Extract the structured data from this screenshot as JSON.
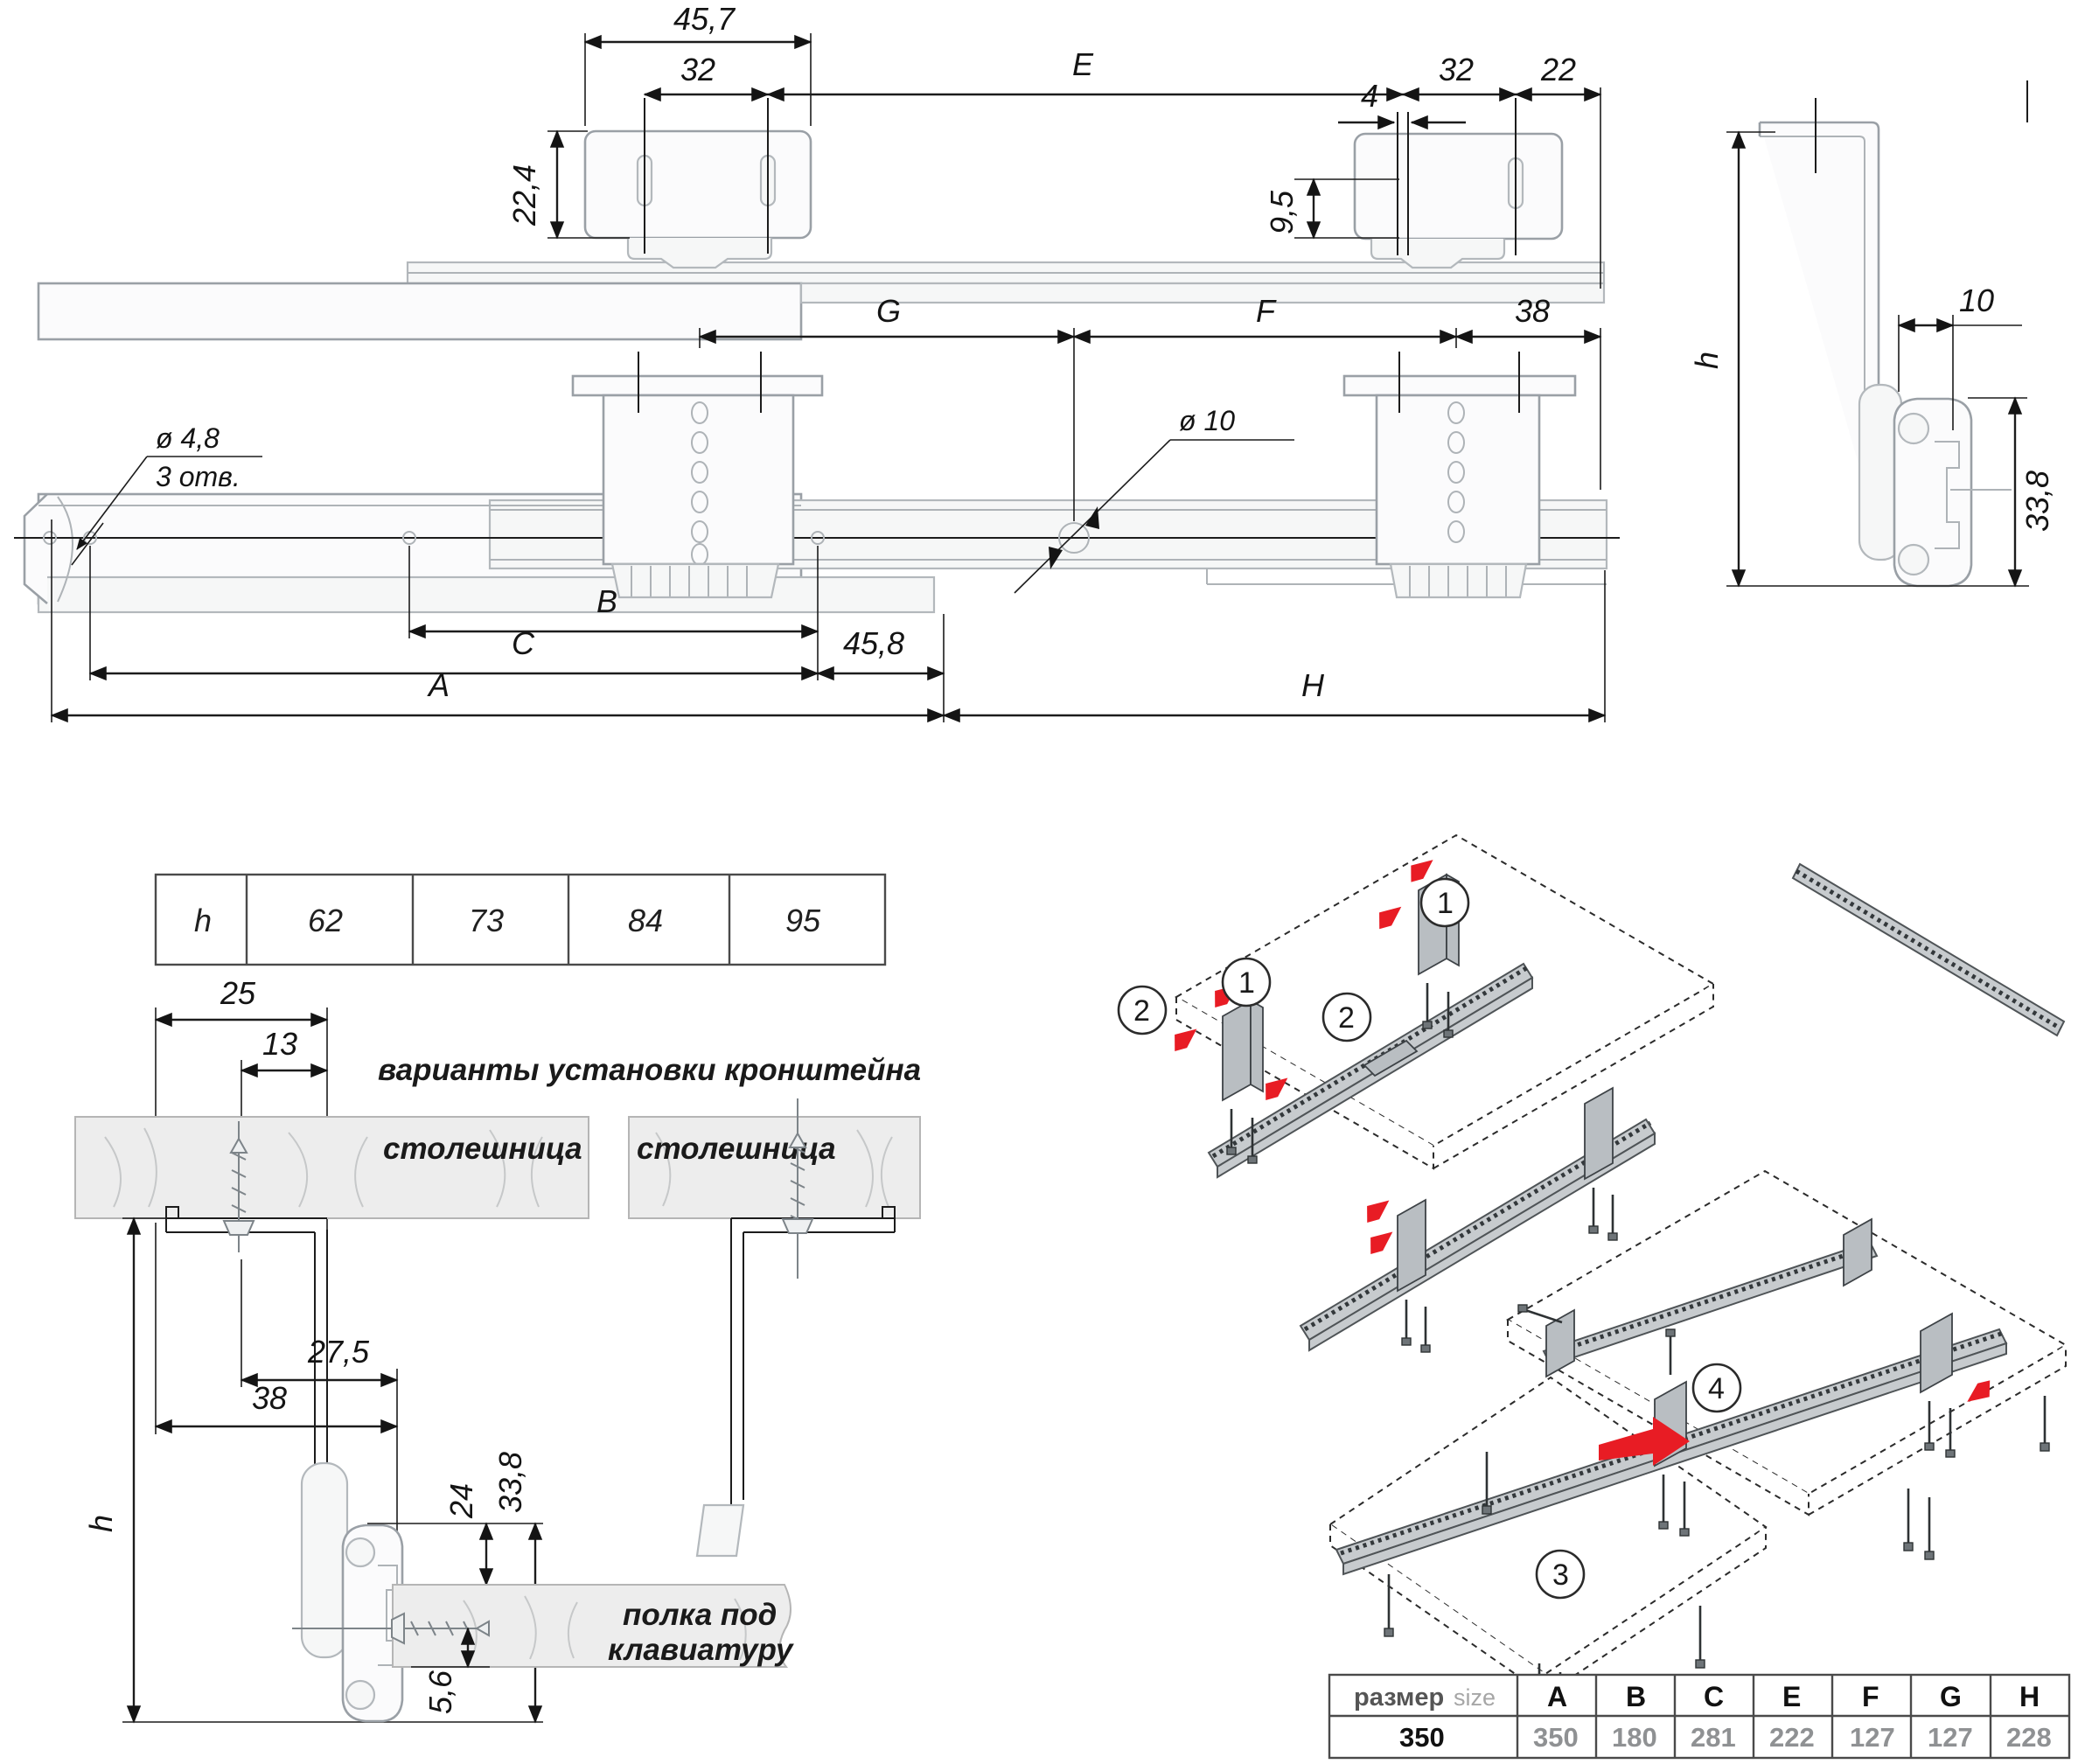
{
  "colors": {
    "accent_red": "#e81c24",
    "line_dark": "#1c1c1c",
    "part_gray": "#9aa0a6",
    "fill_light": "#f1f2f3",
    "slab_gray": "#ececec",
    "muted_value": "#8f9193"
  },
  "top_view": {
    "d45_7": "45,7",
    "d32_left": "32",
    "dE": "E",
    "d32_right": "32",
    "d22": "22",
    "d22_4": "22,4",
    "d9_5": "9,5",
    "d4": "4"
  },
  "plan_view": {
    "dG": "G",
    "dF": "F",
    "d38": "38",
    "dia4_8": "ø 4,8",
    "dia4_8_qty": "3 отв.",
    "dia10": "ø 10",
    "dB": "B",
    "dC": "C",
    "d45_8": "45,8",
    "dA": "A",
    "dH": "H"
  },
  "side_view": {
    "dh": "h",
    "d10": "10",
    "d33_8": "33,8"
  },
  "h_table": {
    "label": "h",
    "values": [
      "62",
      "73",
      "84",
      "95"
    ]
  },
  "install": {
    "title": "варианты установки кронштейна",
    "tabletop_left": "столешница",
    "tabletop_right": "столешница",
    "d25": "25",
    "d13": "13",
    "d27_5": "27,5",
    "d38": "38",
    "dh": "h",
    "d24": "24",
    "d33_8": "33,8",
    "d5_6": "5,6",
    "shelf_line1": "полка под",
    "shelf_line2": "клавиатуру"
  },
  "assembly": {
    "c1a": "1",
    "c2a": "2",
    "c1b": "1",
    "c2b": "2",
    "c3": "3",
    "c4": "4"
  },
  "size_table": {
    "header_ru": "размер",
    "header_en": "size",
    "columns": [
      "A",
      "B",
      "C",
      "E",
      "F",
      "G",
      "H"
    ],
    "row_name": "350",
    "values": [
      "350",
      "180",
      "281",
      "222",
      "127",
      "127",
      "228"
    ]
  }
}
